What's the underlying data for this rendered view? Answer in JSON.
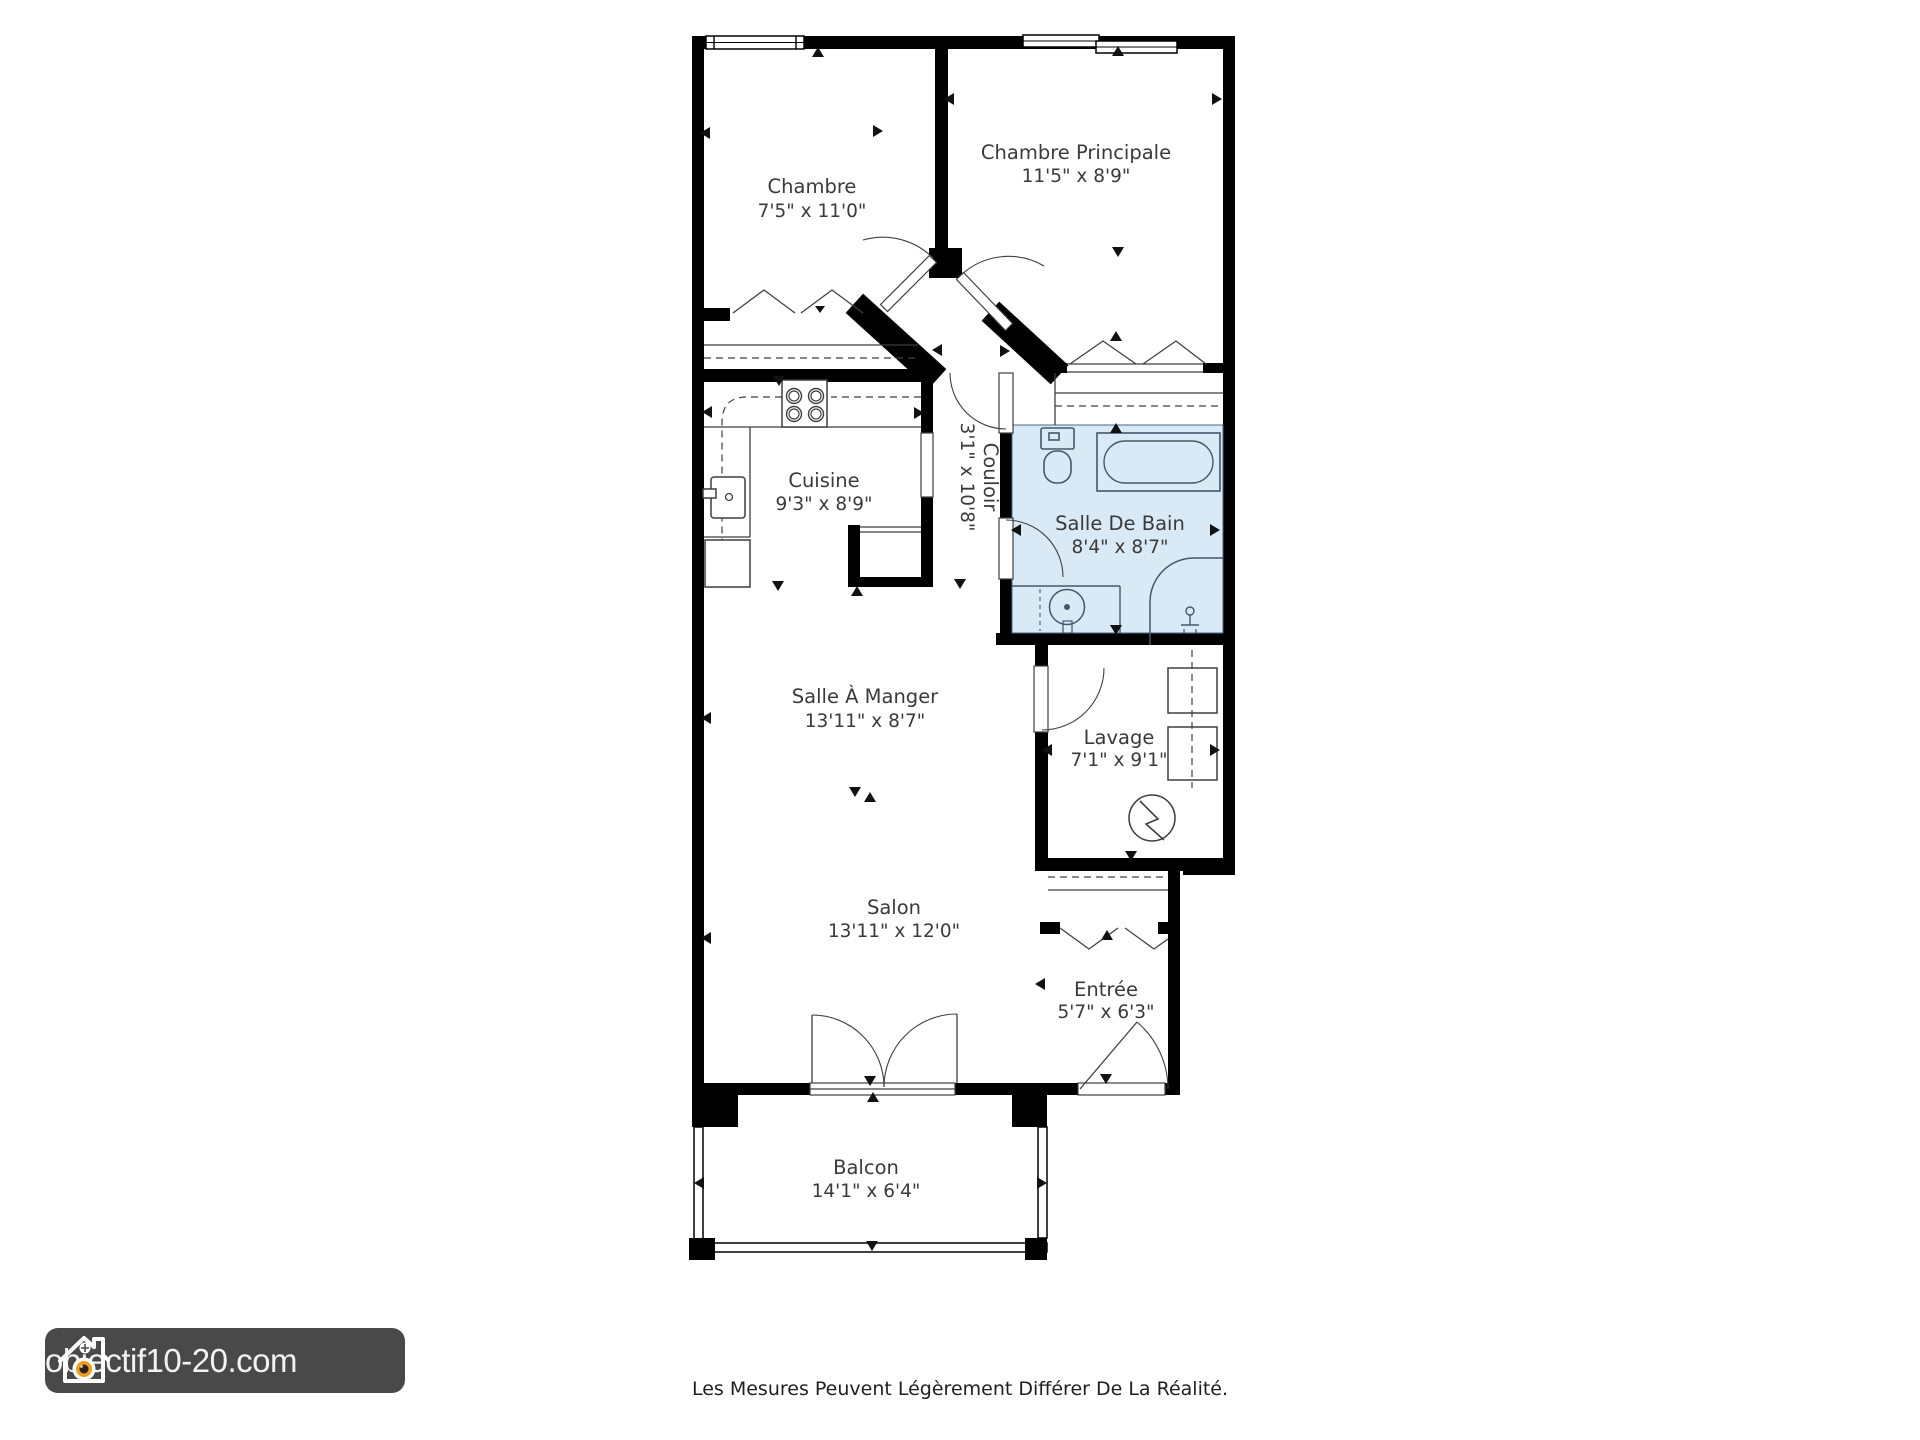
{
  "plan": {
    "rooms": [
      {
        "id": "chambre",
        "name": "Chambre",
        "dims": "7'5\" x 11'0\""
      },
      {
        "id": "chambre-principale",
        "name": "Chambre Principale",
        "dims": "11'5\" x 8'9\""
      },
      {
        "id": "cuisine",
        "name": "Cuisine",
        "dims": "9'3\" x 8'9\""
      },
      {
        "id": "couloir",
        "name": "Couloir",
        "dims": "3'1\" x 10'8\""
      },
      {
        "id": "salle-de-bain",
        "name": "Salle De Bain",
        "dims": "8'4\" x 8'7\""
      },
      {
        "id": "salle-a-manger",
        "name": "Salle À Manger",
        "dims": "13'11\" x 8'7\""
      },
      {
        "id": "lavage",
        "name": "Lavage",
        "dims": "7'1\" x 9'1\""
      },
      {
        "id": "salon",
        "name": "Salon",
        "dims": "13'11\" x 12'0\""
      },
      {
        "id": "entree",
        "name": "Entrée",
        "dims": "5'7\" x 6'3\""
      },
      {
        "id": "balcon",
        "name": "Balcon",
        "dims": "14'1\" x 6'4\""
      }
    ],
    "fixtures": [
      "stove-icon",
      "kitchen-sink-icon",
      "fridge-icon",
      "toilet-icon",
      "bathtub-icon",
      "vanity-sink-icon",
      "shower-icon",
      "washer-icon",
      "dryer-icon",
      "water-heater-icon",
      "closet-hangers-icon"
    ],
    "colors": {
      "wall": "#000000",
      "line": "#3f3f3f",
      "label_text": "#3a3a3a",
      "bathroom_fill": "#d9e9f6",
      "bathroom_stroke": "#42586c"
    }
  },
  "logo": {
    "text": "objectif10-20.com",
    "icon": "house-camera-icon",
    "background": "#494949",
    "orange": "#ef9f20"
  },
  "footer": {
    "disclaimer": "Les Mesures Peuvent Légèrement Différer De La Réalité."
  }
}
